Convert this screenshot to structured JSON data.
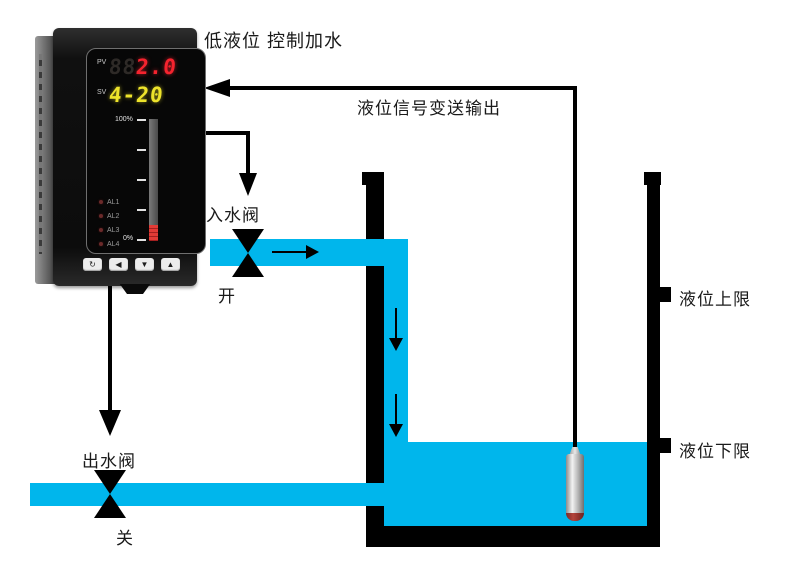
{
  "title": "低液位 控制加水",
  "signal_label": "液位信号变送输出",
  "tank": {
    "upper_limit_label": "液位上限",
    "lower_limit_label": "液位下限"
  },
  "inlet_valve": {
    "label": "入水阀",
    "state": "开"
  },
  "outlet_valve": {
    "label": "出水阀",
    "state": "关"
  },
  "meter": {
    "pv_label": "PV",
    "pv_ghost": "88",
    "pv_value": "2.0",
    "sv_label": "SV",
    "sv_value": "4-20",
    "bargraph": {
      "top": "100%",
      "bottom": "0%",
      "fill_percent": 13
    },
    "leds": [
      "AL1",
      "AL2",
      "AL3",
      "AL4"
    ],
    "buttons": [
      "↻",
      "◀",
      "▼",
      "▲"
    ]
  },
  "colors": {
    "water": "#00b6ec",
    "line_black": "#000000",
    "pv_red": "#f5232e",
    "sv_yellow": "#ede32b",
    "bar_red": "#e23b36"
  }
}
